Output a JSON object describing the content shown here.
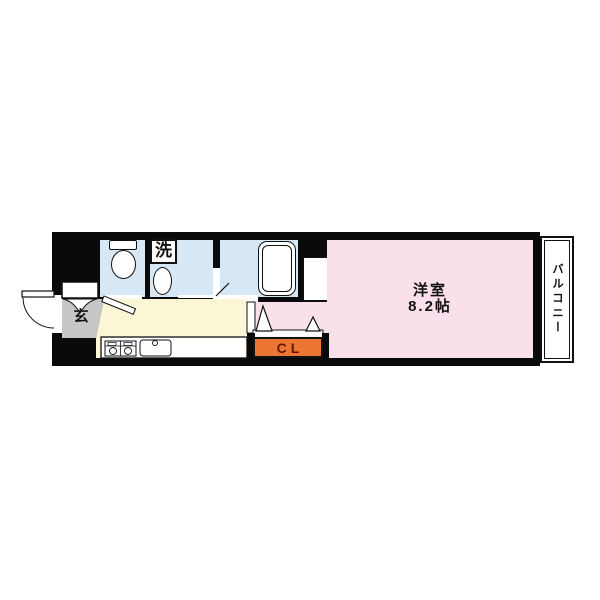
{
  "floorplan": {
    "type": "japanese-apartment-1k-layout",
    "rooms": {
      "entrance": {
        "label": "玄"
      },
      "laundry": {
        "label": "洗"
      },
      "western_room": {
        "name": "洋室",
        "size": "8.2帖"
      },
      "closet": {
        "label": "CL"
      },
      "balcony": {
        "label": "バルコニー"
      }
    },
    "icons": [
      "toilet-icon",
      "washing-machine-icon",
      "bathtub-icon",
      "stove-icon",
      "sink-icon",
      "door-swing-icon",
      "folding-door-icon",
      "shoe-cabinet-icon"
    ],
    "colors": {
      "walls": "#0a0a0a",
      "wet_rooms": "#d6e8f5",
      "western_room": "#f9e0eb",
      "kitchen": "#fbf7d6",
      "entrance": "#c7c7c7",
      "closet": "#ec7634",
      "closet_text": "#6b1500",
      "background": "#ffffff"
    }
  }
}
